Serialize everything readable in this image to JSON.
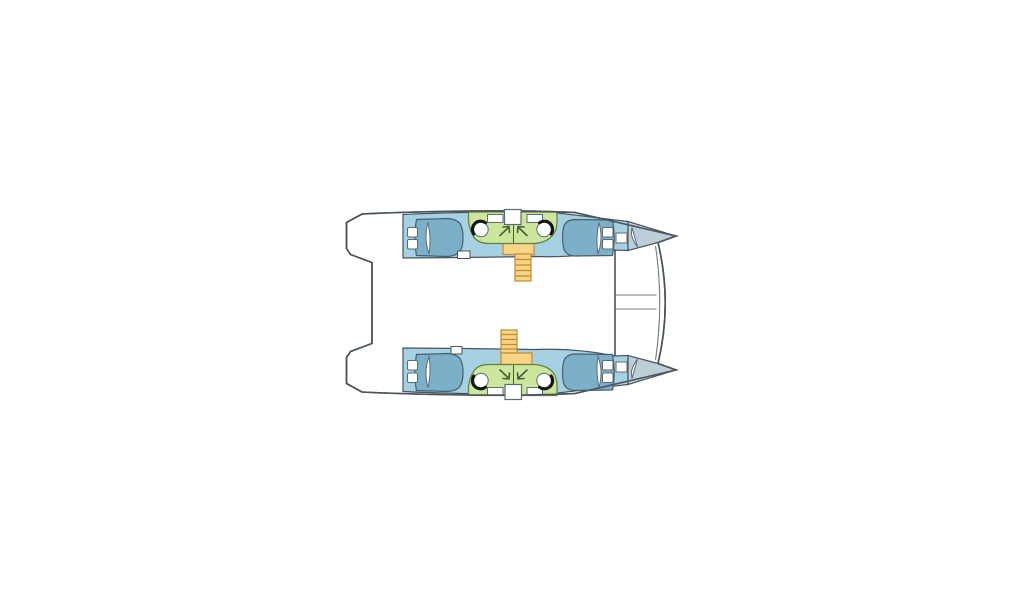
{
  "diagram": {
    "type": "catamaran-deck-plan",
    "view": "top-down",
    "orientation": "bow-right",
    "features": {
      "hulls": 2,
      "double_berths": 4,
      "berth_pillows": 8,
      "washroom_areas": 2,
      "washbasins": 4,
      "companionway_stairs": 2,
      "companionway_doors": 2,
      "deck_hatches": 2,
      "foredeck_crossbeam": 1
    },
    "colors": {
      "background": "#ffffff",
      "outline": "#4a545c",
      "hull": "#a6d1e2",
      "bed": "#7cb0c9",
      "bed_outline": "#44606e",
      "foredeck": "#bccfd8",
      "washroom": "#cde69d",
      "washroom_outline": "#647b41",
      "stairs": "#f7d585",
      "stairs_outline": "#c08a35",
      "fixture_fill": "#ffffff",
      "fixture_stroke": "#5b6b75",
      "basin_arc": "#141414",
      "arrow": "#4e5a35",
      "rigging": "#707a81"
    }
  }
}
